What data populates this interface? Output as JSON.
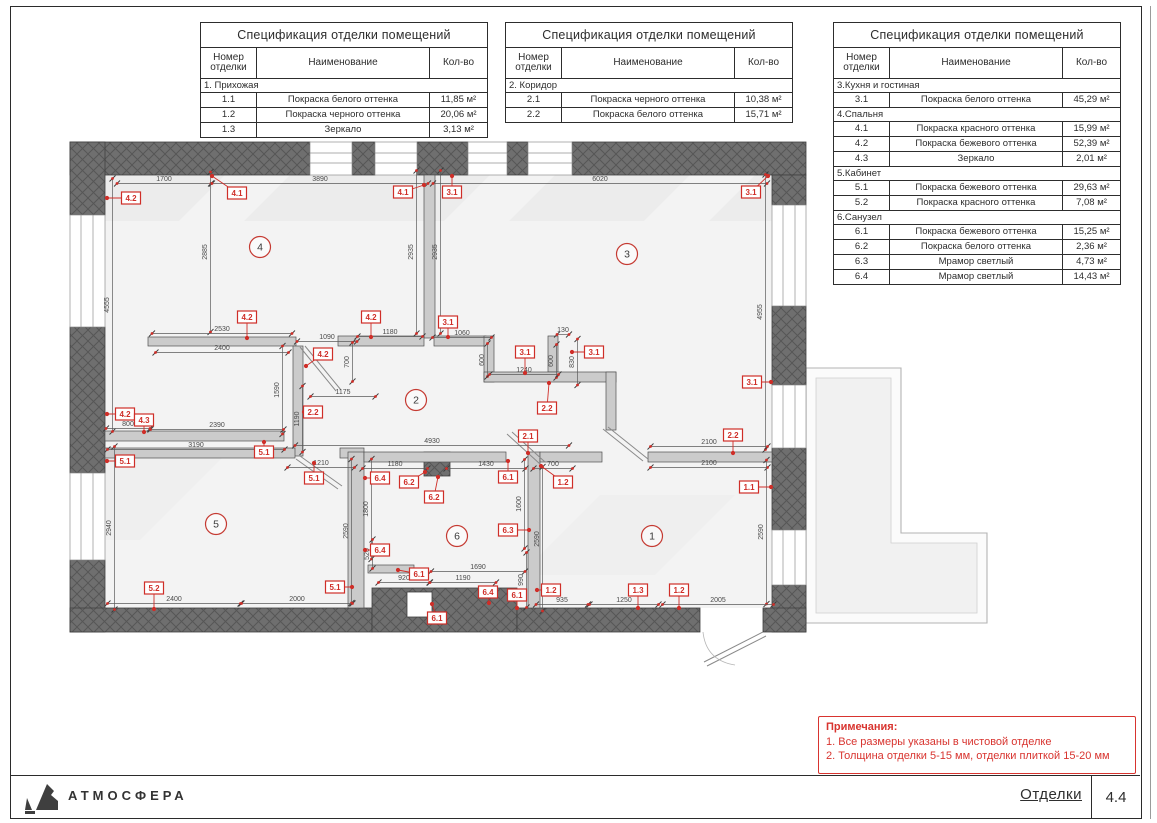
{
  "sheet": {
    "brand": "АТМОСФЕРА",
    "doc_title": "Отделки",
    "sheet_number": "4.4"
  },
  "tables": [
    {
      "title": "Спецификация отделки помещений",
      "headers": [
        "Номер отделки",
        "Наименование",
        "Кол-во"
      ],
      "groups": [
        {
          "name": "1. Прихожая",
          "rows": [
            [
              "1.1",
              "Покраска  белого оттенка",
              "11,85 м²"
            ],
            [
              "1.2",
              "Покраска  черного оттенка",
              "20,06 м²"
            ],
            [
              "1.3",
              "Зеркало",
              "3,13 м²"
            ]
          ]
        }
      ]
    },
    {
      "title": "Спецификация отделки помещений",
      "headers": [
        "Номер отделки",
        "Наименование",
        "Кол-во"
      ],
      "groups": [
        {
          "name": "2. Коридор",
          "rows": [
            [
              "2.1",
              "Покраска  черного оттенка",
              "10,38 м²"
            ],
            [
              "2.2",
              "Покраска  белого оттенка",
              "15,71 м²"
            ]
          ]
        }
      ]
    },
    {
      "title": "Спецификация отделки помещений",
      "headers": [
        "Номер отделки",
        "Наименование",
        "Кол-во"
      ],
      "groups": [
        {
          "name": "3.Кухня и гостиная",
          "rows": [
            [
              "3.1",
              "Покраска  белого оттенка",
              "45,29 м²"
            ]
          ]
        },
        {
          "name": "4.Спальня",
          "rows": [
            [
              "4.1",
              "Покраска  красного оттенка",
              "15,99 м²"
            ],
            [
              "4.2",
              "Покраска  бежевого оттенка",
              "52,39 м²"
            ],
            [
              "4.3",
              "Зеркало",
              "2,01 м²"
            ]
          ]
        },
        {
          "name": "5.Кабинет",
          "rows": [
            [
              "5.1",
              "Покраска  бежевого оттенка",
              "29,63 м²"
            ],
            [
              "5.2",
              "Покраска  красного оттенка",
              "7,08 м²"
            ]
          ]
        },
        {
          "name": "6.Санузел",
          "rows": [
            [
              "6.1",
              "Покраска  бежевого оттенка",
              "15,25 м²"
            ],
            [
              "6.2",
              "Покраска  белого оттенка",
              "2,36 м²"
            ],
            [
              "6.3",
              "Мрамор светлый",
              "4,73 м²"
            ],
            [
              "6.4",
              "Мрамор светлый",
              "14,43 м²"
            ]
          ]
        }
      ]
    }
  ],
  "notes": {
    "title": "Примечания:",
    "lines": [
      "1. Все размеры указаны в чистовой отделке",
      "2. Толщина отделки 5-15 мм, отделки плиткой 15-20 мм"
    ]
  },
  "plan": {
    "rooms": [
      {
        "n": "4",
        "x": 260,
        "y": 247
      },
      {
        "n": "3",
        "x": 627,
        "y": 254
      },
      {
        "n": "2",
        "x": 416,
        "y": 400
      },
      {
        "n": "5",
        "x": 216,
        "y": 524
      },
      {
        "n": "6",
        "x": 457,
        "y": 536
      },
      {
        "n": "1",
        "x": 652,
        "y": 536
      }
    ],
    "markers": [
      {
        "t": "4.2",
        "x": 131,
        "y": 198,
        "mx": 107,
        "my": 198
      },
      {
        "t": "4.1",
        "x": 237,
        "y": 193,
        "mx": 212,
        "my": 176
      },
      {
        "t": "4.1",
        "x": 403,
        "y": 192,
        "mx": 424,
        "my": 185
      },
      {
        "t": "3.1",
        "x": 452,
        "y": 192,
        "mx": 452,
        "my": 176
      },
      {
        "t": "3.1",
        "x": 751,
        "y": 192,
        "mx": 768,
        "my": 176
      },
      {
        "t": "4.2",
        "x": 247,
        "y": 317,
        "mx": 247,
        "my": 338
      },
      {
        "t": "4.2",
        "x": 371,
        "y": 317,
        "mx": 371,
        "my": 337
      },
      {
        "t": "3.1",
        "x": 448,
        "y": 322,
        "mx": 448,
        "my": 337
      },
      {
        "t": "4.2",
        "x": 323,
        "y": 354,
        "mx": 306,
        "my": 366
      },
      {
        "t": "3.1",
        "x": 525,
        "y": 352,
        "mx": 525,
        "my": 373
      },
      {
        "t": "3.1",
        "x": 594,
        "y": 352,
        "mx": 572,
        "my": 352
      },
      {
        "t": "2.2",
        "x": 547,
        "y": 408,
        "mx": 549,
        "my": 383
      },
      {
        "t": "2.2",
        "x": 313,
        "y": 412,
        "mx": 304,
        "my": 412
      },
      {
        "t": "4.2",
        "x": 125,
        "y": 414,
        "mx": 107,
        "my": 414
      },
      {
        "t": "4.3",
        "x": 144,
        "y": 420,
        "mx": 144,
        "my": 432
      },
      {
        "t": "3.1",
        "x": 752,
        "y": 382,
        "mx": 771,
        "my": 382
      },
      {
        "t": "5.1",
        "x": 125,
        "y": 461,
        "mx": 107,
        "my": 461
      },
      {
        "t": "5.1",
        "x": 264,
        "y": 452,
        "mx": 264,
        "my": 442
      },
      {
        "t": "5.1",
        "x": 314,
        "y": 478,
        "mx": 314,
        "my": 463
      },
      {
        "t": "2.1",
        "x": 528,
        "y": 436,
        "mx": 528,
        "my": 453
      },
      {
        "t": "2.2",
        "x": 733,
        "y": 435,
        "mx": 733,
        "my": 453
      },
      {
        "t": "1.1",
        "x": 749,
        "y": 487,
        "mx": 771,
        "my": 487
      },
      {
        "t": "6.4",
        "x": 380,
        "y": 478,
        "mx": 365,
        "my": 478
      },
      {
        "t": "6.2",
        "x": 409,
        "y": 482,
        "mx": 425,
        "my": 472
      },
      {
        "t": "6.2",
        "x": 434,
        "y": 497,
        "mx": 438,
        "my": 477
      },
      {
        "t": "6.1",
        "x": 508,
        "y": 477,
        "mx": 508,
        "my": 461
      },
      {
        "t": "1.2",
        "x": 563,
        "y": 482,
        "mx": 541,
        "my": 466
      },
      {
        "t": "6.3",
        "x": 508,
        "y": 530,
        "mx": 529,
        "my": 530
      },
      {
        "t": "6.4",
        "x": 380,
        "y": 550,
        "mx": 365,
        "my": 550
      },
      {
        "t": "6.1",
        "x": 419,
        "y": 574,
        "mx": 398,
        "my": 570
      },
      {
        "t": "5.2",
        "x": 154,
        "y": 588,
        "mx": 154,
        "my": 609
      },
      {
        "t": "5.1",
        "x": 335,
        "y": 587,
        "mx": 352,
        "my": 587
      },
      {
        "t": "6.1",
        "x": 437,
        "y": 618,
        "mx": 432,
        "my": 604
      },
      {
        "t": "6.4",
        "x": 488,
        "y": 592,
        "mx": 489,
        "my": 603
      },
      {
        "t": "6.1",
        "x": 517,
        "y": 595,
        "mx": 517,
        "my": 608
      },
      {
        "t": "1.2",
        "x": 551,
        "y": 590,
        "mx": 537,
        "my": 590
      },
      {
        "t": "1.3",
        "x": 638,
        "y": 590,
        "mx": 638,
        "my": 608
      },
      {
        "t": "1.2",
        "x": 679,
        "y": 590,
        "mx": 679,
        "my": 608
      }
    ],
    "dims": [
      {
        "t": "1700",
        "x": 164,
        "y": 180,
        "o": "h"
      },
      {
        "t": "3890",
        "x": 320,
        "y": 180,
        "o": "h"
      },
      {
        "t": "6020",
        "x": 600,
        "y": 180,
        "o": "h"
      },
      {
        "t": "2885",
        "x": 207,
        "y": 252,
        "o": "v"
      },
      {
        "t": "2935",
        "x": 413,
        "y": 252,
        "o": "v"
      },
      {
        "t": "2935",
        "x": 437,
        "y": 252,
        "o": "v"
      },
      {
        "t": "4555",
        "x": 109,
        "y": 305,
        "o": "v"
      },
      {
        "t": "4955",
        "x": 762,
        "y": 312,
        "o": "v"
      },
      {
        "t": "2530",
        "x": 222,
        "y": 330,
        "o": "h"
      },
      {
        "t": "2400",
        "x": 222,
        "y": 349,
        "o": "h"
      },
      {
        "t": "1090",
        "x": 327,
        "y": 338,
        "o": "h"
      },
      {
        "t": "1180",
        "x": 390,
        "y": 333,
        "o": "h"
      },
      {
        "t": "1060",
        "x": 462,
        "y": 334,
        "o": "h"
      },
      {
        "t": "130",
        "x": 563,
        "y": 331,
        "o": "h"
      },
      {
        "t": "600",
        "x": 484,
        "y": 360,
        "o": "v"
      },
      {
        "t": "600",
        "x": 553,
        "y": 361,
        "o": "v"
      },
      {
        "t": "830",
        "x": 574,
        "y": 362,
        "o": "v"
      },
      {
        "t": "1240",
        "x": 524,
        "y": 371,
        "o": "h"
      },
      {
        "t": "1175",
        "x": 343,
        "y": 393,
        "o": "h"
      },
      {
        "t": "700",
        "x": 349,
        "y": 362,
        "o": "v"
      },
      {
        "t": "1190",
        "x": 299,
        "y": 419,
        "o": "v"
      },
      {
        "t": "1590",
        "x": 279,
        "y": 390,
        "o": "v"
      },
      {
        "t": "800",
        "x": 128,
        "y": 425,
        "o": "h"
      },
      {
        "t": "2390",
        "x": 217,
        "y": 426,
        "o": "h"
      },
      {
        "t": "3190",
        "x": 196,
        "y": 446,
        "o": "h"
      },
      {
        "t": "4930",
        "x": 432,
        "y": 442,
        "o": "h"
      },
      {
        "t": "2940",
        "x": 111,
        "y": 528,
        "o": "v"
      },
      {
        "t": "1210",
        "x": 321,
        "y": 464,
        "o": "h"
      },
      {
        "t": "1180",
        "x": 395,
        "y": 465,
        "o": "h"
      },
      {
        "t": "1430",
        "x": 486,
        "y": 465,
        "o": "h"
      },
      {
        "t": "700",
        "x": 553,
        "y": 465,
        "o": "h"
      },
      {
        "t": "2100",
        "x": 709,
        "y": 443,
        "o": "h"
      },
      {
        "t": "2100",
        "x": 709,
        "y": 464,
        "o": "h"
      },
      {
        "t": "1800",
        "x": 368,
        "y": 509,
        "o": "v"
      },
      {
        "t": "1600",
        "x": 521,
        "y": 504,
        "o": "v"
      },
      {
        "t": "2590",
        "x": 348,
        "y": 531,
        "o": "v"
      },
      {
        "t": "2590",
        "x": 539,
        "y": 539,
        "o": "v"
      },
      {
        "t": "2590",
        "x": 763,
        "y": 532,
        "o": "v"
      },
      {
        "t": "520",
        "x": 369,
        "y": 554,
        "o": "v"
      },
      {
        "t": "990",
        "x": 523,
        "y": 580,
        "o": "v"
      },
      {
        "t": "1690",
        "x": 478,
        "y": 568,
        "o": "h"
      },
      {
        "t": "1190",
        "x": 463,
        "y": 579,
        "o": "h"
      },
      {
        "t": "920",
        "x": 404,
        "y": 579,
        "o": "h"
      },
      {
        "t": "2400",
        "x": 174,
        "y": 600,
        "o": "h"
      },
      {
        "t": "2000",
        "x": 297,
        "y": 600,
        "o": "h"
      },
      {
        "t": "935",
        "x": 562,
        "y": 601,
        "o": "h"
      },
      {
        "t": "1250",
        "x": 624,
        "y": 601,
        "o": "h"
      },
      {
        "t": "2005",
        "x": 718,
        "y": 601,
        "o": "h"
      }
    ]
  },
  "colors": {
    "accent_red": "#cf2e28",
    "exterior_wall": "#6f6f6f",
    "interior_wall": "#cbcbcb",
    "floor": "#f3f3f3"
  }
}
